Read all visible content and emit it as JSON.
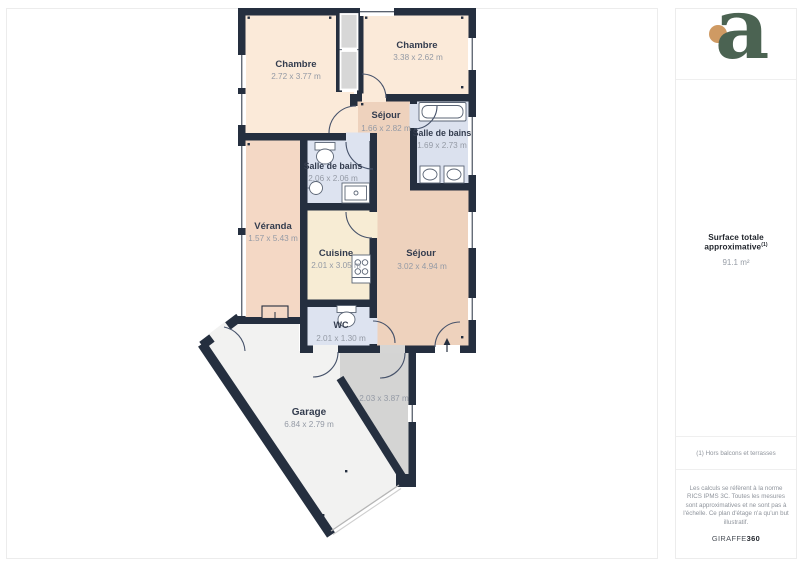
{
  "page": {
    "background": "#ffffff",
    "border_color": "#ececec"
  },
  "plan": {
    "wall_color": "#252f3f",
    "rooms": [
      {
        "name": "Chambre",
        "dims": "2.72 x 3.77 m"
      },
      {
        "name": "Chambre",
        "dims": "3.38 x 2.62 m"
      },
      {
        "name": "Séjour",
        "dims": "1.66 x 2.82 m"
      },
      {
        "name": "Salle de bains",
        "dims": "1.69 x 2.73 m"
      },
      {
        "name": "Salle de bains",
        "dims": "2.06 x 2.06 m"
      },
      {
        "name": "Véranda",
        "dims": "1.57 x 5.43 m"
      },
      {
        "name": "Cuisine",
        "dims": "2.01 x 3.05 m"
      },
      {
        "name": "Séjour",
        "dims": "3.02 x 4.94 m"
      },
      {
        "name": "WC",
        "dims": "2.01 x 1.30 m"
      },
      {
        "name": "Garage",
        "dims": "6.84 x 2.79 m"
      },
      {
        "name": "",
        "dims": "2.03 x 3.87 m"
      }
    ]
  },
  "sidebar": {
    "logo_letter": "a",
    "logo_green": "#4b6352",
    "logo_orange": "#cf9a63",
    "surface_label": "Surface totale approximative",
    "surface_superscript": "(1)",
    "surface_value": "91.1 m²",
    "footnote": "(1) Hors balcons et terrasses",
    "disclaimer": "Les calculs se réfèrent à la norme RICS IPMS 3C. Toutes les mesures sont approximatives et ne sont pas à l'échelle. Ce plan d'étage n'a qu'un but illustratif.",
    "brand_name": "GIRAFFE",
    "brand_suffix": "360"
  }
}
